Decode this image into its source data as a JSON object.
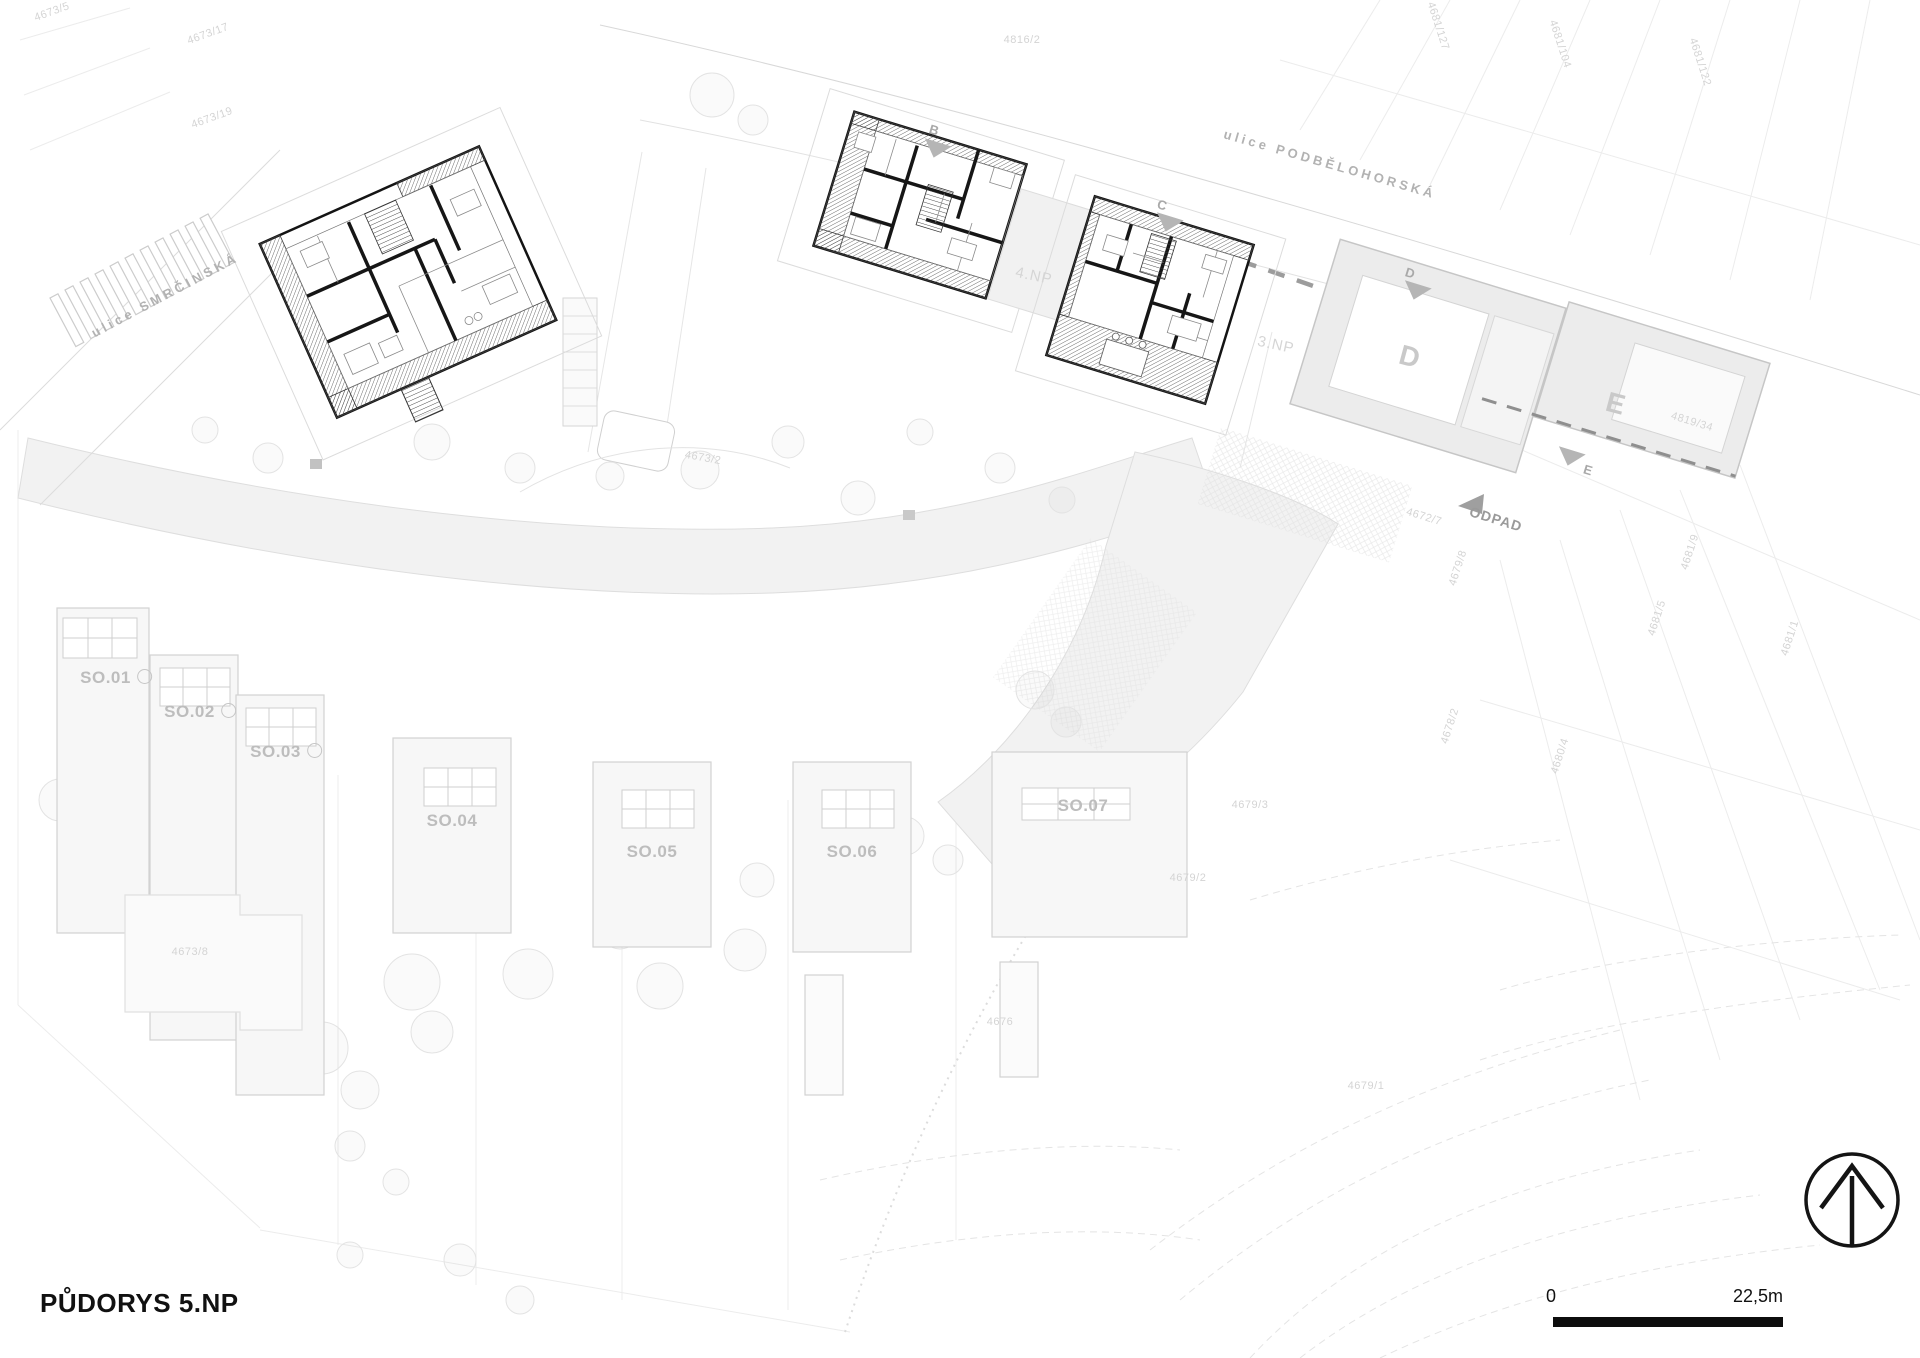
{
  "page": {
    "title": "PŮDORYS 5.NP"
  },
  "scale_bar": {
    "zero": "0",
    "max": "22,5m"
  },
  "streets": {
    "smrcinska": "ulice SMRČINSKÁ",
    "podbelohorska": "ulice PODBĚLOHORSKÁ"
  },
  "area_labels": {
    "building_d": "D",
    "building_e": "E",
    "level_4np": "4.NP",
    "level_3np": "3.NP",
    "odpad": "ODPAD"
  },
  "section_markers": {
    "b": "B",
    "c": "C",
    "d": "D",
    "e": "E"
  },
  "villas": [
    {
      "label": "SO.01"
    },
    {
      "label": "SO.02"
    },
    {
      "label": "SO.03"
    },
    {
      "label": "SO.04"
    },
    {
      "label": "SO.05"
    },
    {
      "label": "SO.06"
    },
    {
      "label": "SO.07"
    }
  ],
  "parcels": [
    {
      "text": "4673/5"
    },
    {
      "text": "4673/17"
    },
    {
      "text": "4673/19"
    },
    {
      "text": "4816/2"
    },
    {
      "text": "4681/127"
    },
    {
      "text": "4681/104"
    },
    {
      "text": "4681/122"
    },
    {
      "text": "4819/34"
    },
    {
      "text": "4672/7"
    },
    {
      "text": "4679/8"
    },
    {
      "text": "4678/2"
    },
    {
      "text": "4680/4"
    },
    {
      "text": "4681/9"
    },
    {
      "text": "4681/5"
    },
    {
      "text": "4681/1"
    },
    {
      "text": "4679/2"
    },
    {
      "text": "4679/1"
    },
    {
      "text": "4676"
    },
    {
      "text": "4679/3"
    },
    {
      "text": "4673/8"
    },
    {
      "text": "4673/2"
    }
  ],
  "colors": {
    "plan_black": "#141414",
    "light_gray": "#ececec",
    "line_gray": "#d6d6d6",
    "label_gray": "#b8b8b8",
    "hatch_gray": "#4a4a4a"
  }
}
